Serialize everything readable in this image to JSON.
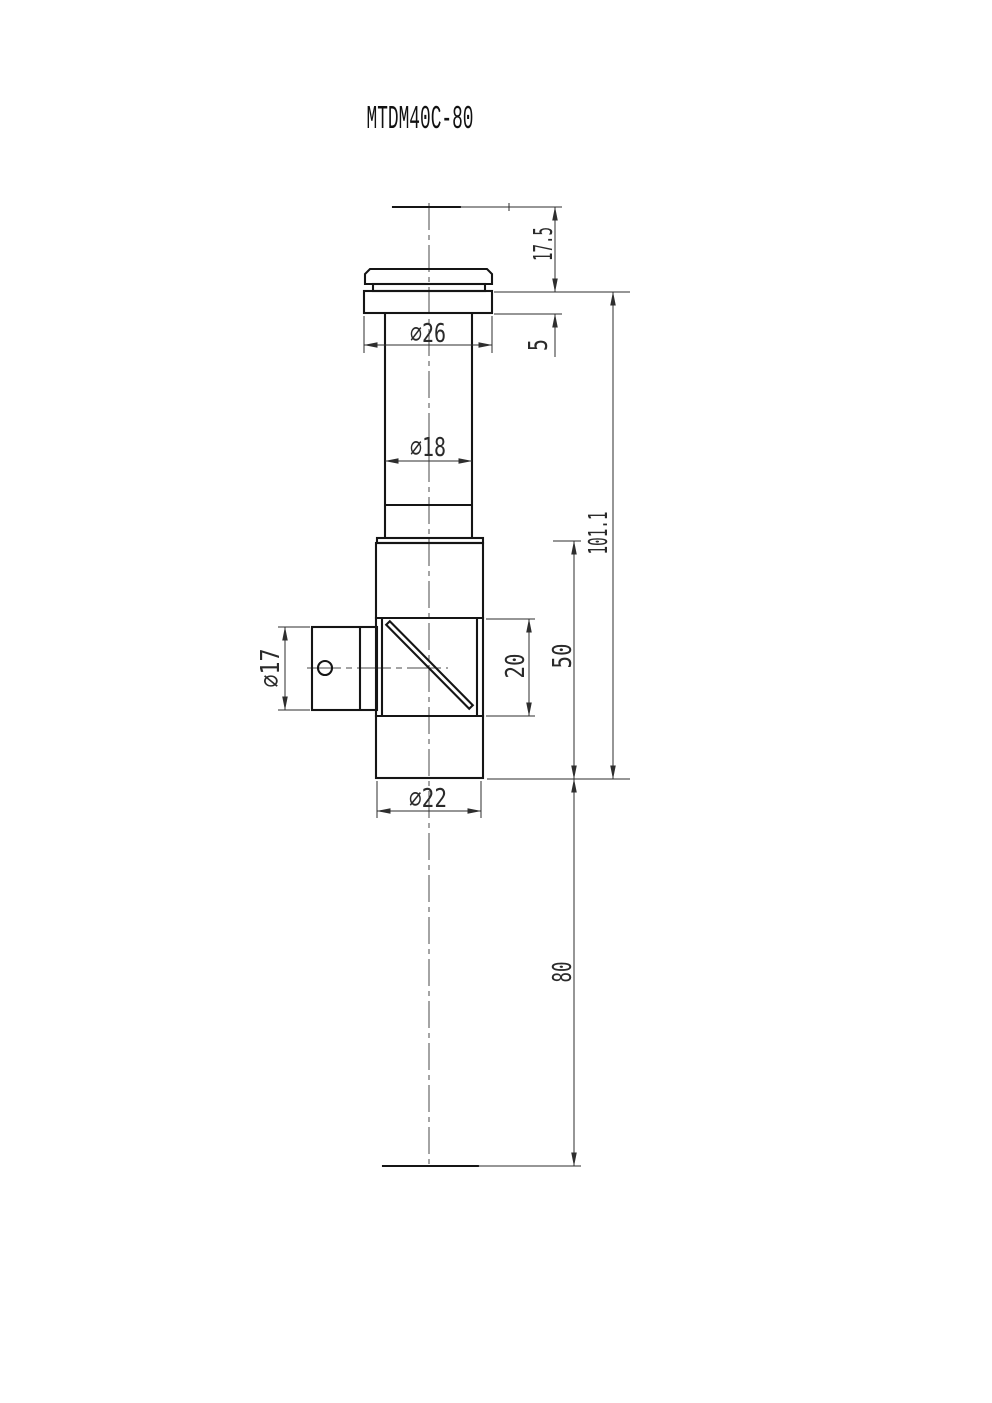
{
  "title": "MTDM40C-80",
  "dims": {
    "top_offset": "17.5",
    "flange_thickness": "5",
    "flange_diameter": "∅26",
    "tube_diameter": "∅18",
    "overall_length": "101.1",
    "body_length": "50",
    "window_size": "20",
    "body_diameter": "∅22",
    "port_diameter": "∅17",
    "bottom_extension": "80"
  }
}
